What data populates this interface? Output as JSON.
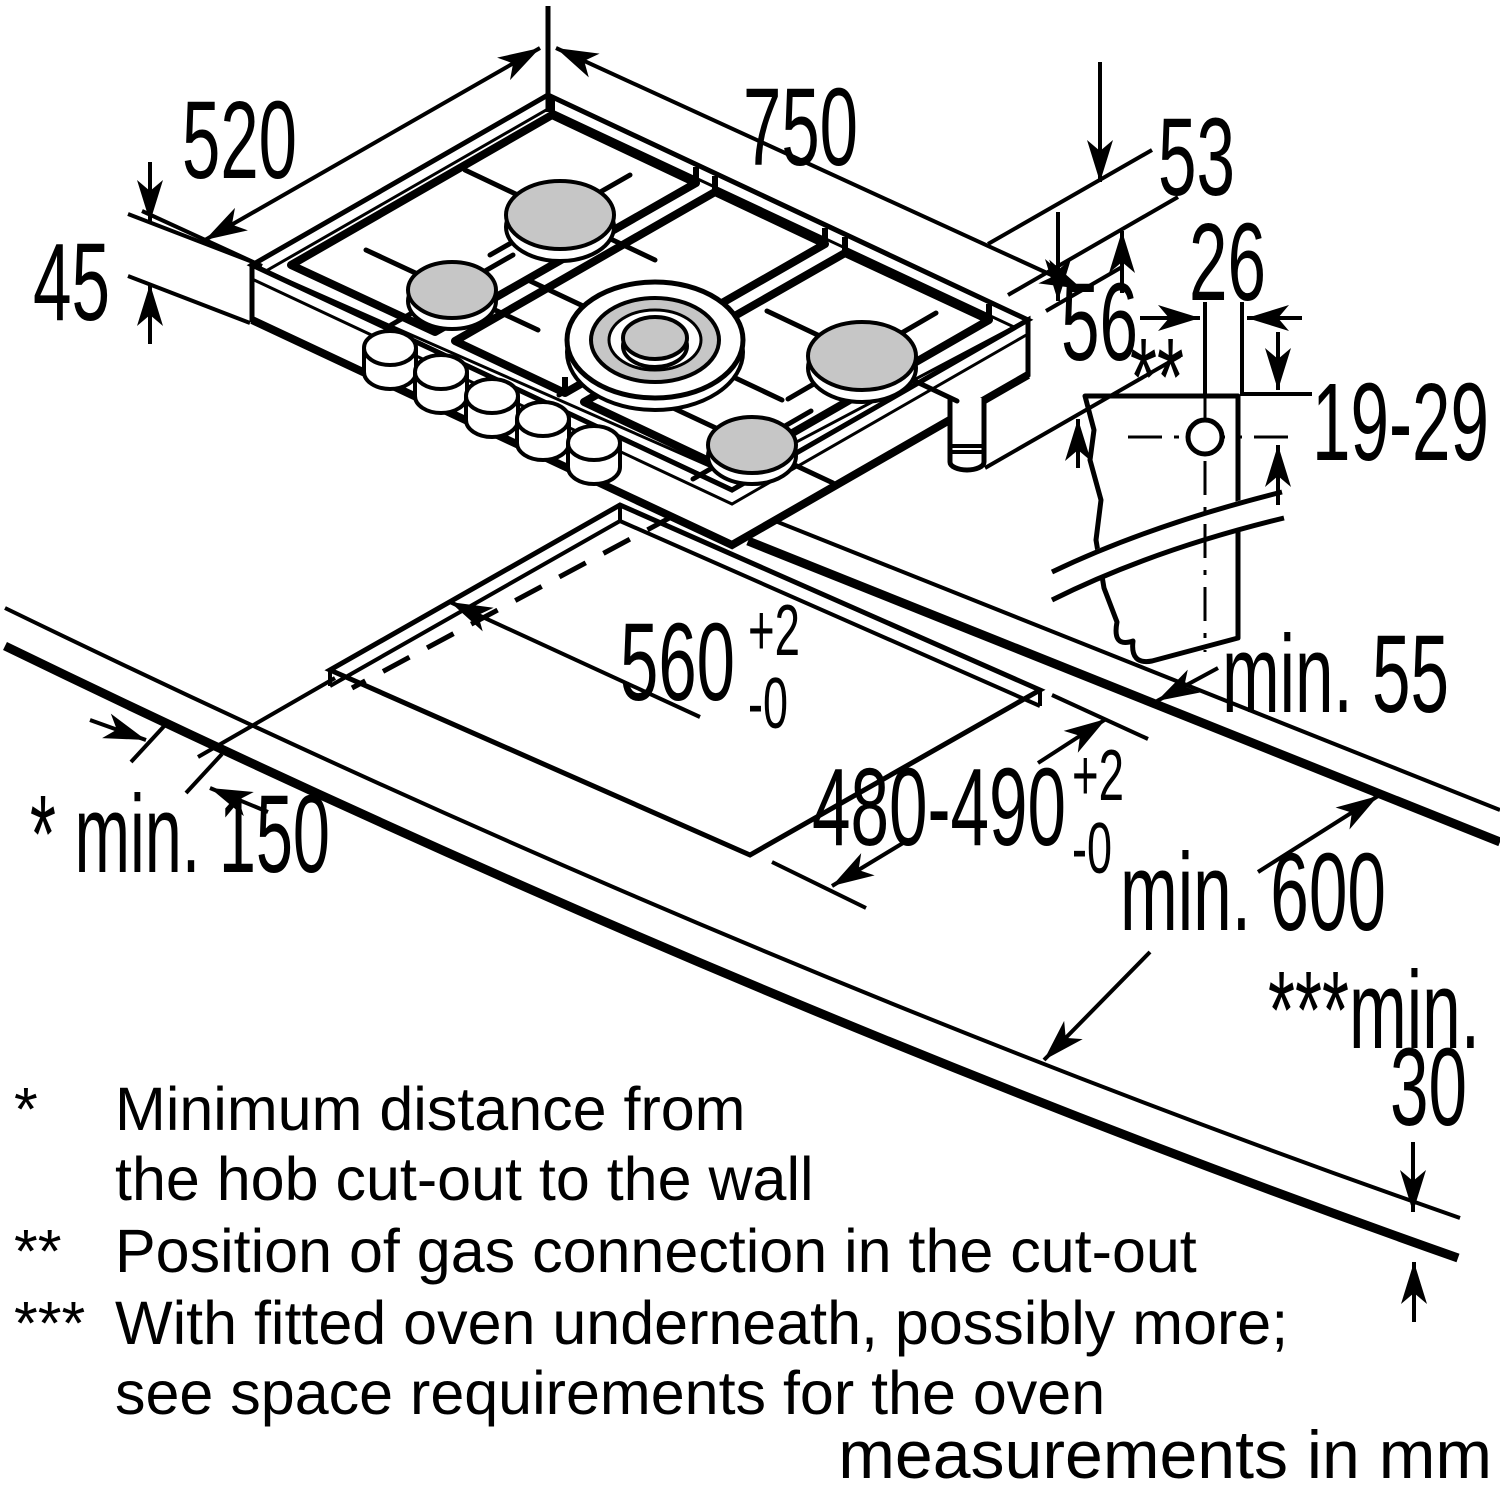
{
  "diagram": {
    "title": "gas hob installation drawing",
    "dimensions": {
      "hob_width": "750",
      "hob_depth": "520",
      "hob_body_height": "45",
      "support_height": "53",
      "below_top_height": "56",
      "gas_offset": "26",
      "gas_depth_range": "19-29",
      "gas_marker": "**",
      "cutout_width": "560",
      "cutout_depth": "480-490",
      "tol_plus": "+2",
      "tol_minus": "-0",
      "rear_clearance": "min. 55",
      "side_clearance": "* min. 150",
      "worktop_depth": "min. 600",
      "front_clearance_label": "***min.",
      "front_clearance_value": "30"
    },
    "footnotes": [
      {
        "marker": "*",
        "line1": "Minimum distance from",
        "line2": "the hob cut-out to the wall"
      },
      {
        "marker": "**",
        "line1": "Position of gas connection in the cut-out"
      },
      {
        "marker": "***",
        "line1": "With fitted oven underneath, possibly more;",
        "line2": "see space requirements for the oven"
      }
    ],
    "units_label": "measurements in mm"
  }
}
